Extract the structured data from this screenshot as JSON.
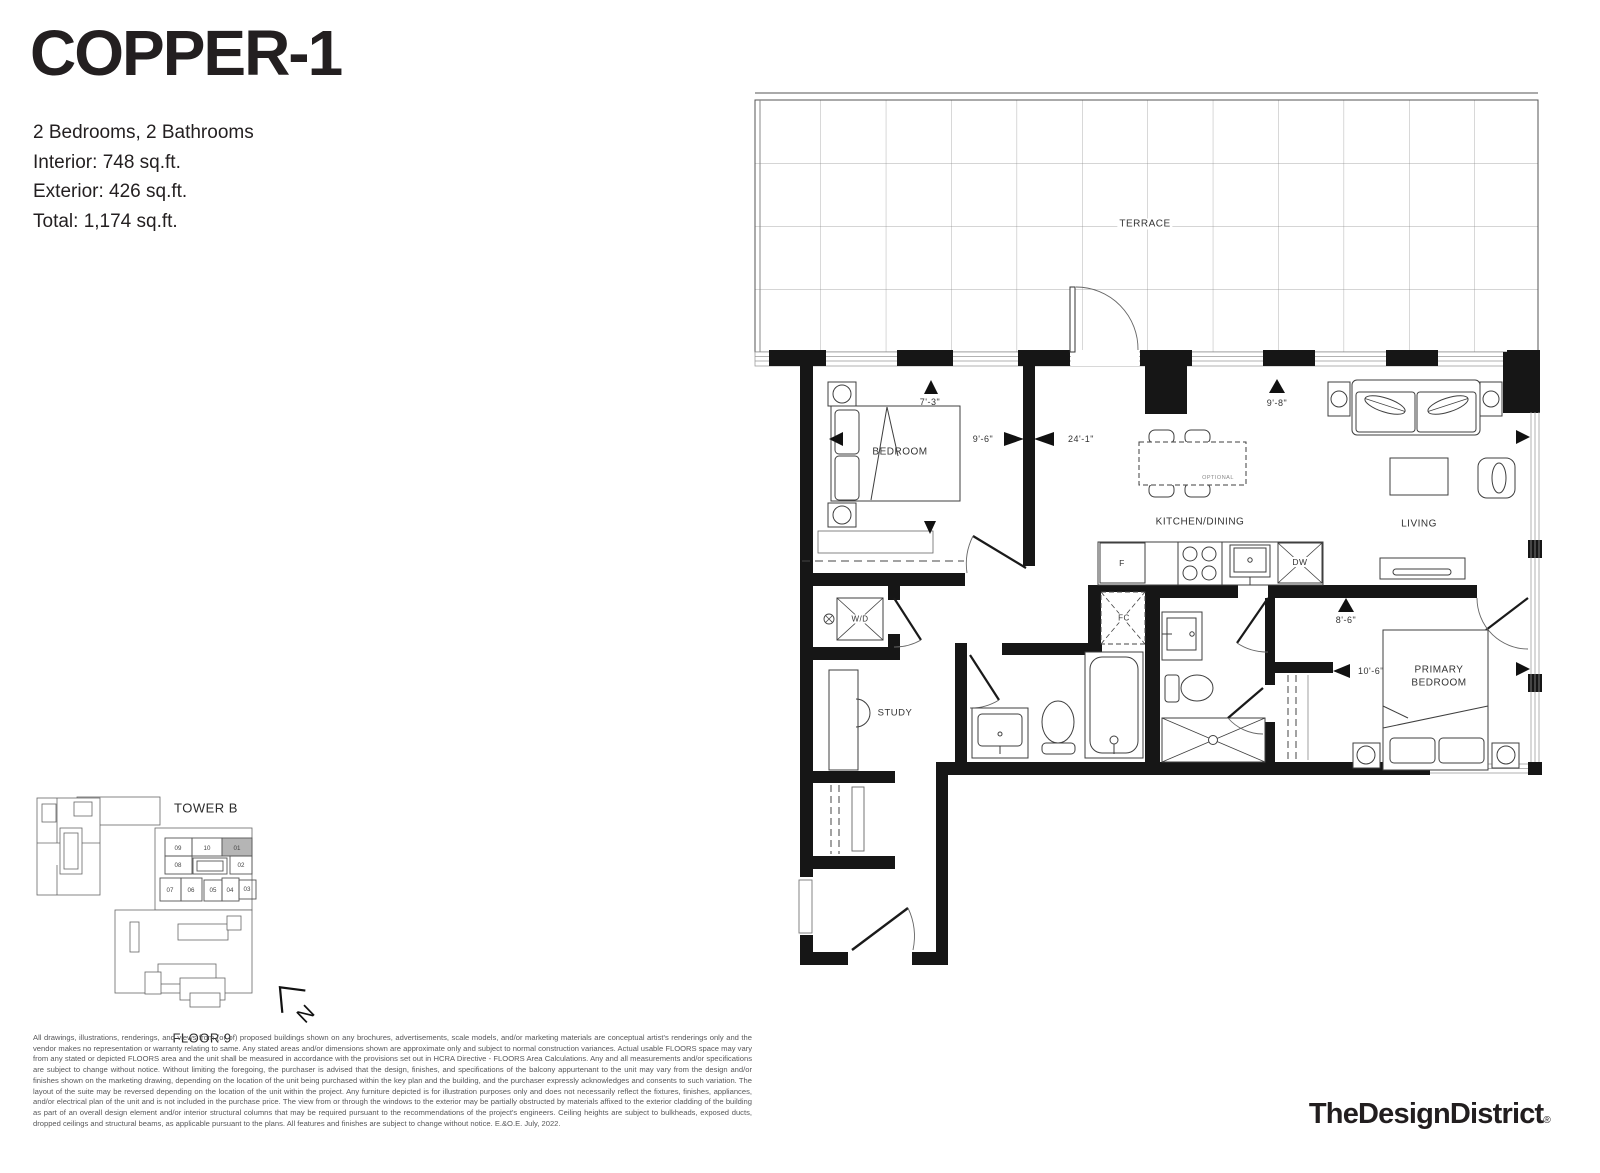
{
  "title": "COPPER-1",
  "stats": {
    "beds_baths": "2 Bedrooms, 2 Bathrooms",
    "interior": "Interior: 748 sq.ft.",
    "exterior": "Exterior: 426 sq.ft.",
    "total": "Total: 1,174 sq.ft."
  },
  "floorplan": {
    "labels": {
      "terrace": "TERRACE",
      "bedroom": "BEDROOM",
      "kitchen_dining": "KITCHEN/DINING",
      "living": "LIVING",
      "primary_bedroom": "PRIMARY BEDROOM",
      "study": "STUDY",
      "washer_dryer": "W/D",
      "fan_coil": "FC",
      "fridge": "F",
      "dishwasher": "DW",
      "optional": "OPTIONAL"
    },
    "dimensions": {
      "bedroom_width": "7'-3\"",
      "bedroom_depth": "9'-6\"",
      "overall_width": "24'-1\"",
      "living_width": "9'-8\"",
      "primary_width": "8'-6\"",
      "primary_depth": "10'-6\""
    }
  },
  "keyplan": {
    "tower": "TOWER B",
    "floor": "FLOOR 9",
    "highlighted_unit": "01",
    "units": [
      "09",
      "10",
      "01",
      "08",
      "02",
      "07",
      "06",
      "05",
      "04",
      "03"
    ],
    "north_label": "N"
  },
  "colors": {
    "wall": "#161616",
    "highlight_unit_fill": "#b5b5b5",
    "text": "#231f20"
  },
  "disclaimer": "All drawings, illustrations, renderings, and views from (or of) proposed buildings shown on any brochures, advertisements, scale models, and/or marketing materials are conceptual artist's renderings only and the vendor makes no representation or warranty relating to same. Any stated areas and/or dimensions shown are approximate only and subject to normal construction variances. Actual usable FLOORS space may vary from any stated or depicted FLOORS area and the unit shall be measured in accordance with the provisions set out in HCRA Directive - FLOORS Area Calculations. Any and all measurements and/or specifications are subject to change without notice. Without limiting the foregoing, the purchaser is advised that the design, finishes, and specifications of the balcony appurtenant to the unit may vary from the design and/or finishes shown on the marketing drawing, depending on the location of the unit being purchased within the key plan and the building, and the purchaser expressly acknowledges and consents to such variation. The layout of the suite may be reversed depending on the location of the unit within the project. Any furniture depicted is for illustration purposes only and does not necessarily reflect the fixtures, finishes, appliances, and/or electrical plan of the unit and is not included in the purchase price. The view from or through the windows to the exterior may be partially obstructed by materials affixed to the exterior cladding of the building as part of an overall design element and/or interior structural columns that may be required pursuant to the recommendations of the project's engineers. Ceiling heights are subject to bulkheads, exposed ducts, dropped ceilings and structural beams, as applicable pursuant to the plans. All features and finishes are subject to change without notice. E.&O.E. July, 2022.",
  "footer": {
    "logo": "TheDesignDistrict",
    "registered": "®"
  }
}
